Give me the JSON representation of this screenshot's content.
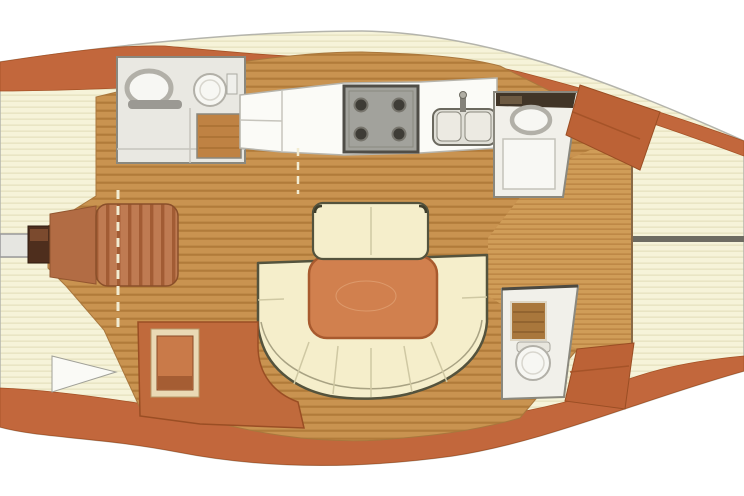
{
  "image": {
    "type": "sailboat-interior-floor-plan",
    "description": "Top-down interior/deck plan of a sailing yacht, bow pointing left, stern to the right",
    "width": 744,
    "height": 496
  },
  "areas": [
    {
      "id": "bow",
      "label": "Bow with anchor sprit and windlass"
    },
    {
      "id": "forward-cabin",
      "label": "Forward cabin with island double berth"
    },
    {
      "id": "forward-head",
      "label": "Forward head: washbasin, toilet, shower grate"
    },
    {
      "id": "galley",
      "label": "Galley: 4-burner stove and double sink"
    },
    {
      "id": "salon",
      "label": "Salon: U-shaped settee, bench seat, dining table"
    },
    {
      "id": "side-settee",
      "label": "Side settee unit with seat frame"
    },
    {
      "id": "aft-head-port",
      "label": "Aft head: washbasin and shower stall"
    },
    {
      "id": "aft-head-starboard",
      "label": "Aft head: shower grate and toilet"
    },
    {
      "id": "companionway",
      "label": "Companionway steps"
    },
    {
      "id": "cockpit",
      "label": "Cockpit sole with teak slats"
    },
    {
      "id": "side-deck",
      "label": "Cream side decks with pinstripes"
    }
  ],
  "colors": {
    "bg": "#ffffff",
    "hull_outline": "#b4b4ac",
    "deck_base": "#f6f3d9",
    "deck_stripe": "#e9e5c4",
    "band": "#c2673c",
    "band_edge": "#a55226",
    "wood_base": "#c99350",
    "wood_stripe": "#b17b3a",
    "wood_edge": "#a9773d",
    "slat_base": "#d09d58",
    "slat_stripe": "#bc8644",
    "divider": "#8a6a46",
    "mattress_base": "#bf7b52",
    "mattress_stripe": "#a25c34",
    "mattress_edge": "#8a4f2a",
    "berth_head": "#b26c44",
    "windlass_dark": "#4e2e1d",
    "windlass_top": "#7b4a2e",
    "sprit": "#e6e6e1",
    "room_floor": "#e9e8e2",
    "room_floor_light": "#f1f0ea",
    "wall": "#8a887e",
    "wall_dark": "#4c4a42",
    "fixture_white": "#f7f7f3",
    "fixture_ring": "#b2b0a8",
    "bar_gray": "#9b9993",
    "grate_fwd": "#bf8243",
    "grate_aft": "#a9773c",
    "stove_body": "#a2a29c",
    "stove_edge": "#4f4d47",
    "burner": "#3e3c36",
    "counter": "#fbfbf7",
    "counter_line": "#c6c4bc",
    "sink_fill": "#eceae2",
    "sink_outer": "#e0dfd7",
    "sink_edge": "#6b695f",
    "shelf_dark": "#413527",
    "shelf_mid": "#6d5a42",
    "shower_floor": "#f8f8f4",
    "settee_cream": "#f5eecb",
    "settee_outline": "#54533d",
    "settee_line": "#cfc8a3",
    "settee_inner": "#a8a283",
    "table_fill": "#d1804e",
    "table_edge": "#a85a2e",
    "table_swirl": "#dd9a6c",
    "side_unit": "#c06a3c",
    "seat_frame": "#ead9b5",
    "seat_fill": "#c97a49",
    "seat_shadow": "#a55d33",
    "comp_block": "#bc6236",
    "comp_line": "#a55328",
    "stern_line": "#6e6c62",
    "door_dash": "#f2ecd2",
    "wedge": "#fafaf6"
  }
}
